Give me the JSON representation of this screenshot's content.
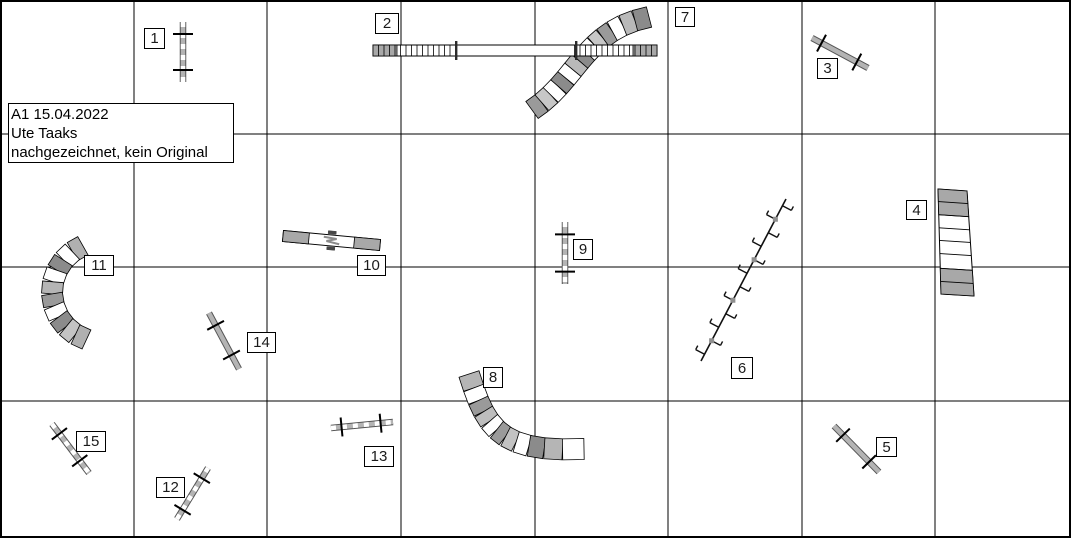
{
  "canvas": {
    "width": 1067,
    "height": 534,
    "background": "#ffffff",
    "border_color": "#000000"
  },
  "info_box": {
    "x": 6,
    "y": 101,
    "w": 226,
    "h": 60,
    "lines": [
      "A1 15.04.2022",
      "Ute Taaks",
      "nachgezeichnet, kein Original"
    ]
  },
  "course": {
    "class": "A1",
    "date": "15.04.2022",
    "author": "Ute Taaks",
    "note": "nachgezeichnet, kein Original"
  },
  "grid": {
    "cols_x": [
      132,
      265,
      399,
      533,
      666,
      800,
      933
    ],
    "rows_y": [
      132,
      265,
      399
    ],
    "line_color": "#000000"
  },
  "colors": {
    "pole_gray": "#b4b4b4",
    "pole_edge": "#555555",
    "contact_gray": "#a8a8a8",
    "tunnel_stroke": "#000000",
    "crossbar_black": "#000000"
  },
  "obstacles": [
    {
      "number": 1,
      "type": "jump",
      "pole": [
        181,
        20,
        181,
        80
      ],
      "banded": true,
      "bar_len": 20,
      "crossbar_ts": [
        0.2,
        0.8
      ],
      "label": [
        142,
        26,
        21,
        21
      ]
    },
    {
      "number": 2,
      "type": "dogwalk",
      "x": 371,
      "y": 43,
      "length": 284,
      "height": 11,
      "ramp_len": 83,
      "slat_step": 5.5,
      "contact_len": 24,
      "pins": [
        454,
        574
      ],
      "label": [
        373,
        11,
        24,
        21
      ]
    },
    {
      "number": 3,
      "type": "jump",
      "pole": [
        810,
        36,
        866,
        66
      ],
      "banded": false,
      "bar_len": 19,
      "crossbar_ts": [
        0.17,
        0.8
      ],
      "label": [
        815,
        56,
        21,
        21
      ]
    },
    {
      "number": 4,
      "type": "aframe",
      "corners": [
        [
          936,
          187
        ],
        [
          965,
          189
        ],
        [
          972,
          294
        ],
        [
          939,
          292
        ]
      ],
      "band_frac": 0.245,
      "slat_fracs": [
        0.12,
        0.245,
        0.37,
        0.49,
        0.615,
        0.755,
        0.88
      ],
      "label": [
        904,
        198,
        21,
        20
      ]
    },
    {
      "number": 5,
      "type": "jump",
      "pole": [
        832,
        424,
        877,
        470
      ],
      "banded": false,
      "bar_len": 19,
      "crossbar_ts": [
        0.2,
        0.78
      ],
      "label": [
        874,
        435,
        21,
        20
      ]
    },
    {
      "number": 6,
      "type": "weave",
      "line": [
        699,
        359,
        784,
        197
      ],
      "poles": 12,
      "label": [
        729,
        355,
        22,
        22
      ]
    },
    {
      "number": 7,
      "type": "tunnel",
      "bezier": [
        [
          530,
          108
        ],
        [
          576,
          78
        ],
        [
          582,
          28
        ],
        [
          647,
          15
        ]
      ],
      "segments": 13,
      "width": 21,
      "fills": [
        "#9a9a9a",
        "#c7c7c7",
        "#ffffff",
        "#8b8b8b",
        "#ffffff",
        "#b9b9b9",
        "#8b8b8b",
        "#ffffff",
        "#c7c7c7",
        "#9a9a9a",
        "#ffffff",
        "#b9b9b9",
        "#8b8b8b"
      ],
      "label": [
        673,
        5,
        20,
        20
      ]
    },
    {
      "number": 8,
      "type": "tunnel",
      "bezier": [
        [
          467,
          372
        ],
        [
          484,
          426
        ],
        [
          497,
          451
        ],
        [
          582,
          447
        ]
      ],
      "segments": 11,
      "width": 21,
      "fills": [
        "#b5b5b5",
        "#ffffff",
        "#9a9a9a",
        "#bdbdbd",
        "#ffffff",
        "#9a9a9a",
        "#c2c2c2",
        "#ffffff",
        "#8b8b8b",
        "#b5b5b5",
        "#ffffff"
      ],
      "label": [
        481,
        365,
        20,
        21
      ]
    },
    {
      "number": 9,
      "type": "jump",
      "pole": [
        563,
        220,
        563,
        282
      ],
      "banded": true,
      "bar_len": 20,
      "crossbar_ts": [
        0.2,
        0.8
      ],
      "label": [
        571,
        237,
        20,
        21
      ]
    },
    {
      "number": 10,
      "type": "seesaw",
      "p1": [
        281,
        234
      ],
      "p2": [
        378,
        243
      ],
      "height": 11,
      "contact_len": 26,
      "label": [
        355,
        253,
        29,
        21
      ]
    },
    {
      "number": 11,
      "type": "tunnel",
      "points": [
        [
          80.9,
          243.8
        ],
        [
          70.4,
          249.7
        ],
        [
          61.5,
          258.1
        ],
        [
          55.0,
          268.3
        ],
        [
          51.0,
          279.8
        ],
        [
          50.0,
          291.9
        ],
        [
          52.0,
          303.9
        ],
        [
          56.7,
          315.0
        ],
        [
          64.1,
          324.7
        ],
        [
          73.5,
          332.4
        ],
        [
          84.5,
          337.5
        ]
      ],
      "segments": 10,
      "width": 21,
      "fills": [
        "#b0b0b0",
        "#ffffff",
        "#8b8b8b",
        "#ffffff",
        "#b5b5b5",
        "#9a9a9a",
        "#ffffff",
        "#8b8b8b",
        "#c4c4c4",
        "#b0b0b0"
      ],
      "label": [
        82,
        253,
        30,
        21
      ]
    },
    {
      "number": 12,
      "type": "jump",
      "pole": [
        175,
        517,
        206,
        466
      ],
      "banded": true,
      "bar_len": 19,
      "crossbar_ts": [
        0.18,
        0.8
      ],
      "label": [
        154,
        475,
        29,
        21
      ]
    },
    {
      "number": 13,
      "type": "jump",
      "pole": [
        329,
        426,
        391,
        420
      ],
      "banded": true,
      "bar_len": 19,
      "crossbar_ts": [
        0.17,
        0.8
      ],
      "label": [
        362,
        444,
        30,
        21
      ]
    },
    {
      "number": 14,
      "type": "jump",
      "pole": [
        207,
        311,
        237,
        367
      ],
      "banded": false,
      "bar_len": 19,
      "crossbar_ts": [
        0.22,
        0.75
      ],
      "label": [
        245,
        330,
        29,
        21
      ]
    },
    {
      "number": 15,
      "type": "jump",
      "pole": [
        50,
        422,
        87,
        471
      ],
      "banded": true,
      "bar_len": 19,
      "crossbar_ts": [
        0.2,
        0.75
      ],
      "label": [
        74,
        429,
        30,
        21
      ]
    }
  ]
}
